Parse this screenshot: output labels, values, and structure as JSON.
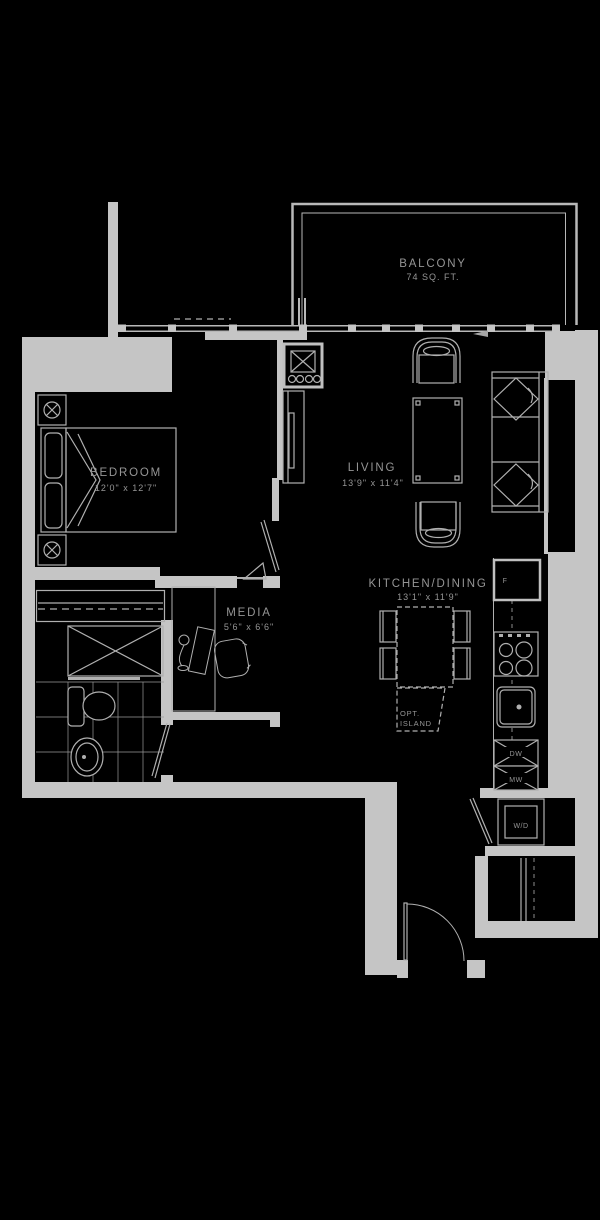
{
  "rooms": {
    "balcony": {
      "name": "BALCONY",
      "area": "74 SQ. FT."
    },
    "bedroom": {
      "name": "BEDROOM",
      "dims": "12'0\" x 12'7\""
    },
    "living": {
      "name": "LIVING",
      "dims": "13'9\" x 11'4\""
    },
    "kitchen_dining": {
      "name": "KITCHEN/DINING",
      "dims": "13'1\" x 11'9\""
    },
    "media": {
      "name": "MEDIA",
      "dims": "5'6\" x 6'6\""
    }
  },
  "fixtures": {
    "optional_island_line1": "OPT.",
    "optional_island_line2": "ISLAND",
    "fridge": "F",
    "dishwasher": "DW",
    "microwave": "MW",
    "washer_dryer": "W/D"
  },
  "colors": {
    "background": "#000000",
    "wall": "#c5c5c5",
    "furniture_line": "#b0b0b0",
    "text": "#959595"
  }
}
